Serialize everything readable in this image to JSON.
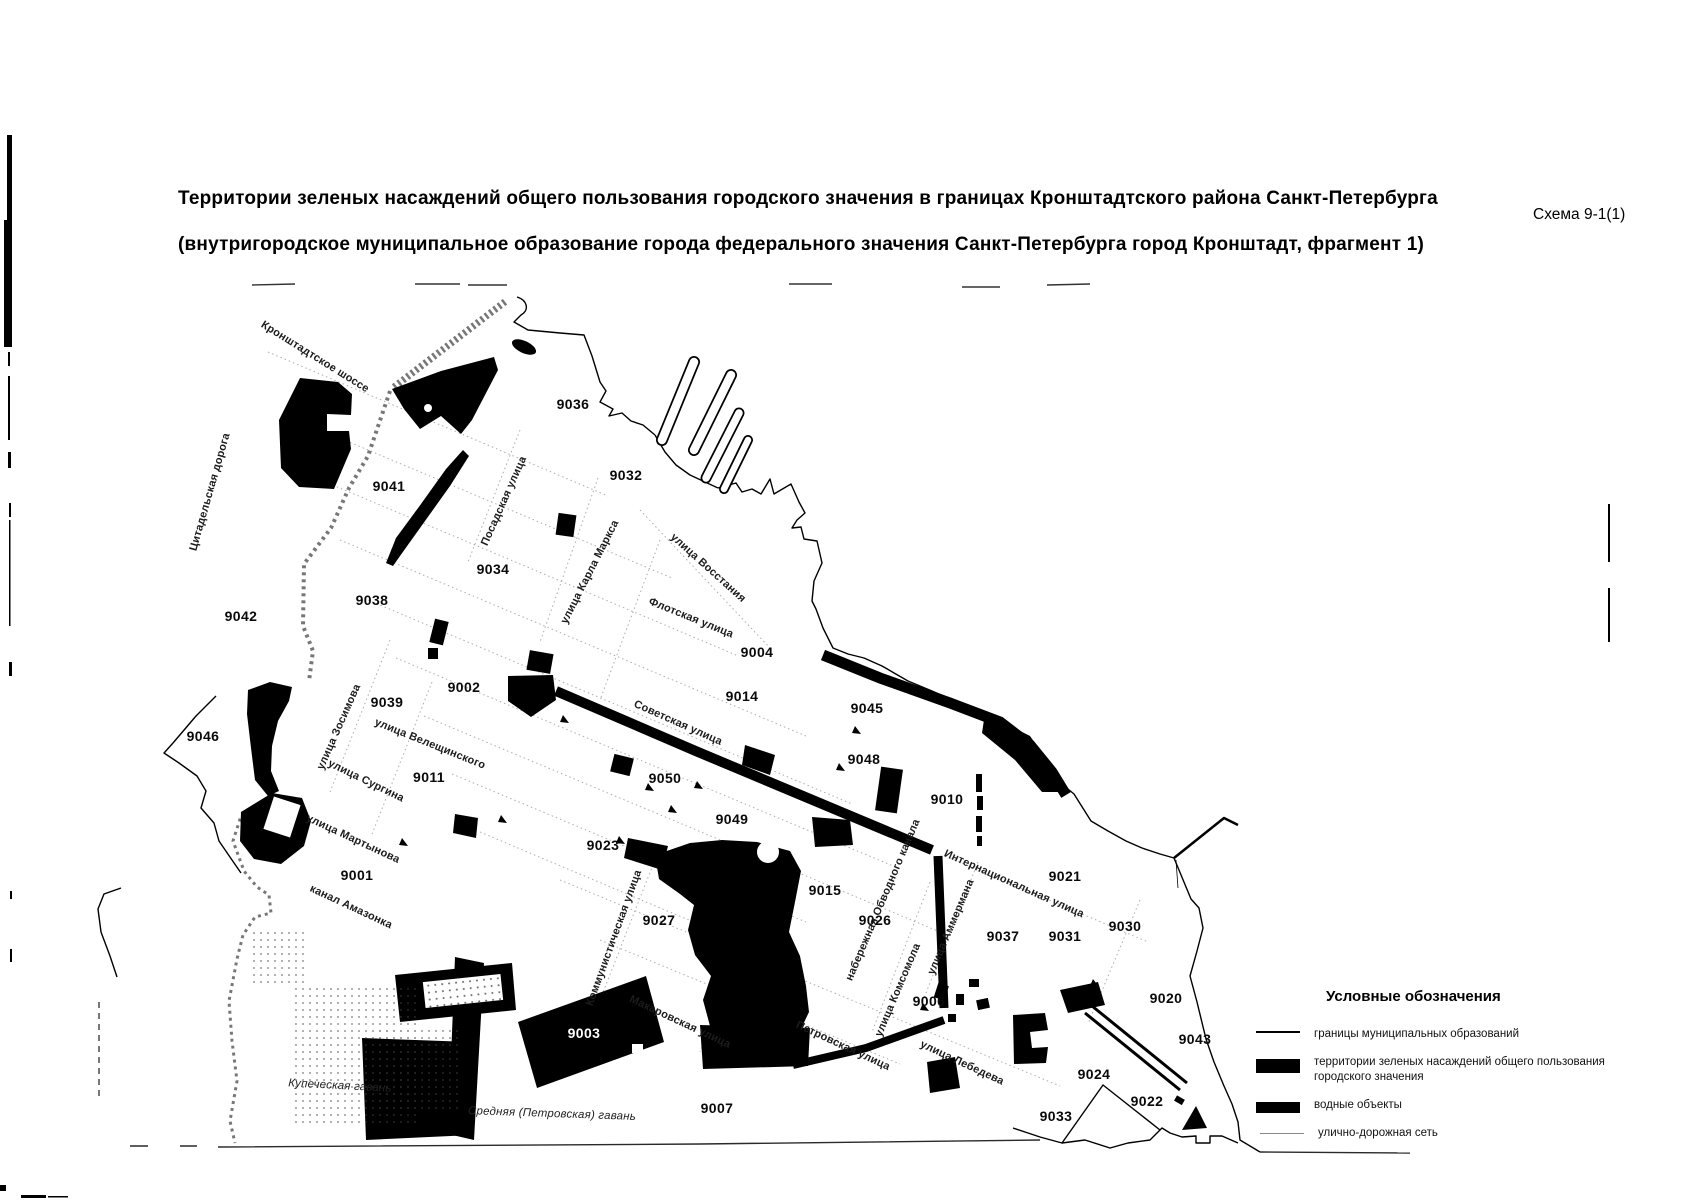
{
  "header": {
    "title_line1": "Территории зеленых насаждений общего пользования городского значения в границах Кронштадтского района Санкт-Петербурга",
    "title_line2": "(внутригородское муниципальное образование города федерального значения Санкт-Петербурга город Кронштадт, фрагмент 1)",
    "scheme_ref": "Схема 9-1(1)"
  },
  "legend": {
    "title": "Условные обозначения",
    "items": [
      {
        "type": "boundary-line",
        "label": "границы муниципальных образований"
      },
      {
        "type": "area-green",
        "label": "территории зеленых насаждений общего пользования городского значения"
      },
      {
        "type": "area-water",
        "label": "водные объекты"
      },
      {
        "type": "road-line",
        "label": "улично-дорожная сеть"
      }
    ]
  },
  "map": {
    "zones": [
      {
        "id": "9036",
        "x": 573,
        "y": 404
      },
      {
        "id": "9041",
        "x": 389,
        "y": 486
      },
      {
        "id": "9032",
        "x": 626,
        "y": 475
      },
      {
        "id": "9034",
        "x": 493,
        "y": 569
      },
      {
        "id": "9038",
        "x": 372,
        "y": 600
      },
      {
        "id": "9042",
        "x": 241,
        "y": 616
      },
      {
        "id": "9004",
        "x": 757,
        "y": 652
      },
      {
        "id": "9002",
        "x": 464,
        "y": 687
      },
      {
        "id": "9014",
        "x": 742,
        "y": 696
      },
      {
        "id": "9045",
        "x": 867,
        "y": 708
      },
      {
        "id": "9039",
        "x": 387,
        "y": 702
      },
      {
        "id": "9046",
        "x": 203,
        "y": 736
      },
      {
        "id": "9048",
        "x": 864,
        "y": 759
      },
      {
        "id": "9011",
        "x": 429,
        "y": 777
      },
      {
        "id": "9050",
        "x": 665,
        "y": 778
      },
      {
        "id": "9010",
        "x": 947,
        "y": 799
      },
      {
        "id": "9049",
        "x": 732,
        "y": 819
      },
      {
        "id": "9023",
        "x": 603,
        "y": 845
      },
      {
        "id": "9021",
        "x": 1065,
        "y": 876
      },
      {
        "id": "9001",
        "x": 357,
        "y": 875
      },
      {
        "id": "9015",
        "x": 825,
        "y": 890
      },
      {
        "id": "9026",
        "x": 875,
        "y": 920
      },
      {
        "id": "9027",
        "x": 659,
        "y": 920
      },
      {
        "id": "9030",
        "x": 1125,
        "y": 926
      },
      {
        "id": "9037",
        "x": 1003,
        "y": 936
      },
      {
        "id": "9031",
        "x": 1065,
        "y": 936
      },
      {
        "id": "9020",
        "x": 1166,
        "y": 998
      },
      {
        "id": "9006",
        "x": 929,
        "y": 1001
      },
      {
        "id": "9003",
        "x": 584,
        "y": 1033,
        "inverted": true
      },
      {
        "id": "9043",
        "x": 1195,
        "y": 1039
      },
      {
        "id": "9024",
        "x": 1094,
        "y": 1074
      },
      {
        "id": "9022",
        "x": 1147,
        "y": 1101
      },
      {
        "id": "9007",
        "x": 717,
        "y": 1108
      },
      {
        "id": "9033",
        "x": 1056,
        "y": 1116
      }
    ],
    "streets": [
      {
        "name": "Кронштадтское шоссе",
        "x": 315,
        "y": 357,
        "angle": 32
      },
      {
        "name": "Цитадельская дорога",
        "x": 210,
        "y": 492,
        "angle": -74
      },
      {
        "name": "Посадская улица",
        "x": 504,
        "y": 501,
        "angle": -66
      },
      {
        "name": "улица Карла Маркса",
        "x": 590,
        "y": 572,
        "angle": -63
      },
      {
        "name": "улица Восстания",
        "x": 708,
        "y": 568,
        "angle": 42
      },
      {
        "name": "Флотская улица",
        "x": 691,
        "y": 618,
        "angle": 22
      },
      {
        "name": "Советская улица",
        "x": 678,
        "y": 723,
        "angle": 24
      },
      {
        "name": "улица Зосимова",
        "x": 339,
        "y": 727,
        "angle": -66
      },
      {
        "name": "улица Велещинского",
        "x": 430,
        "y": 744,
        "angle": 22
      },
      {
        "name": "улица Сургина",
        "x": 366,
        "y": 781,
        "angle": 26
      },
      {
        "name": "улица Мартынова",
        "x": 353,
        "y": 839,
        "angle": 25
      },
      {
        "name": "канал Амазонка",
        "x": 351,
        "y": 907,
        "angle": 25
      },
      {
        "name": "Коммунистическая улица",
        "x": 614,
        "y": 938,
        "angle": -70
      },
      {
        "name": "Макаровская улица",
        "x": 680,
        "y": 1022,
        "angle": 25
      },
      {
        "name": "Петровская улица",
        "x": 843,
        "y": 1046,
        "angle": 25
      },
      {
        "name": "набережная Обводного канала",
        "x": 883,
        "y": 900,
        "angle": -67
      },
      {
        "name": "улица Комсомола",
        "x": 898,
        "y": 990,
        "angle": -67
      },
      {
        "name": "улица Аммермана",
        "x": 951,
        "y": 927,
        "angle": -67
      },
      {
        "name": "Интернациональная улица",
        "x": 1014,
        "y": 884,
        "angle": 24
      },
      {
        "name": "улица Лебедева",
        "x": 962,
        "y": 1063,
        "angle": 25
      },
      {
        "name": "Купеческая гавань",
        "x": 340,
        "y": 1086,
        "angle": 3,
        "style": "water"
      },
      {
        "name": "Средняя (Петровская) гавань",
        "x": 552,
        "y": 1114,
        "angle": 2,
        "style": "water"
      }
    ]
  },
  "colors": {
    "ink": "#000000",
    "street_grid": "#adadad",
    "rampart": "#777777"
  }
}
